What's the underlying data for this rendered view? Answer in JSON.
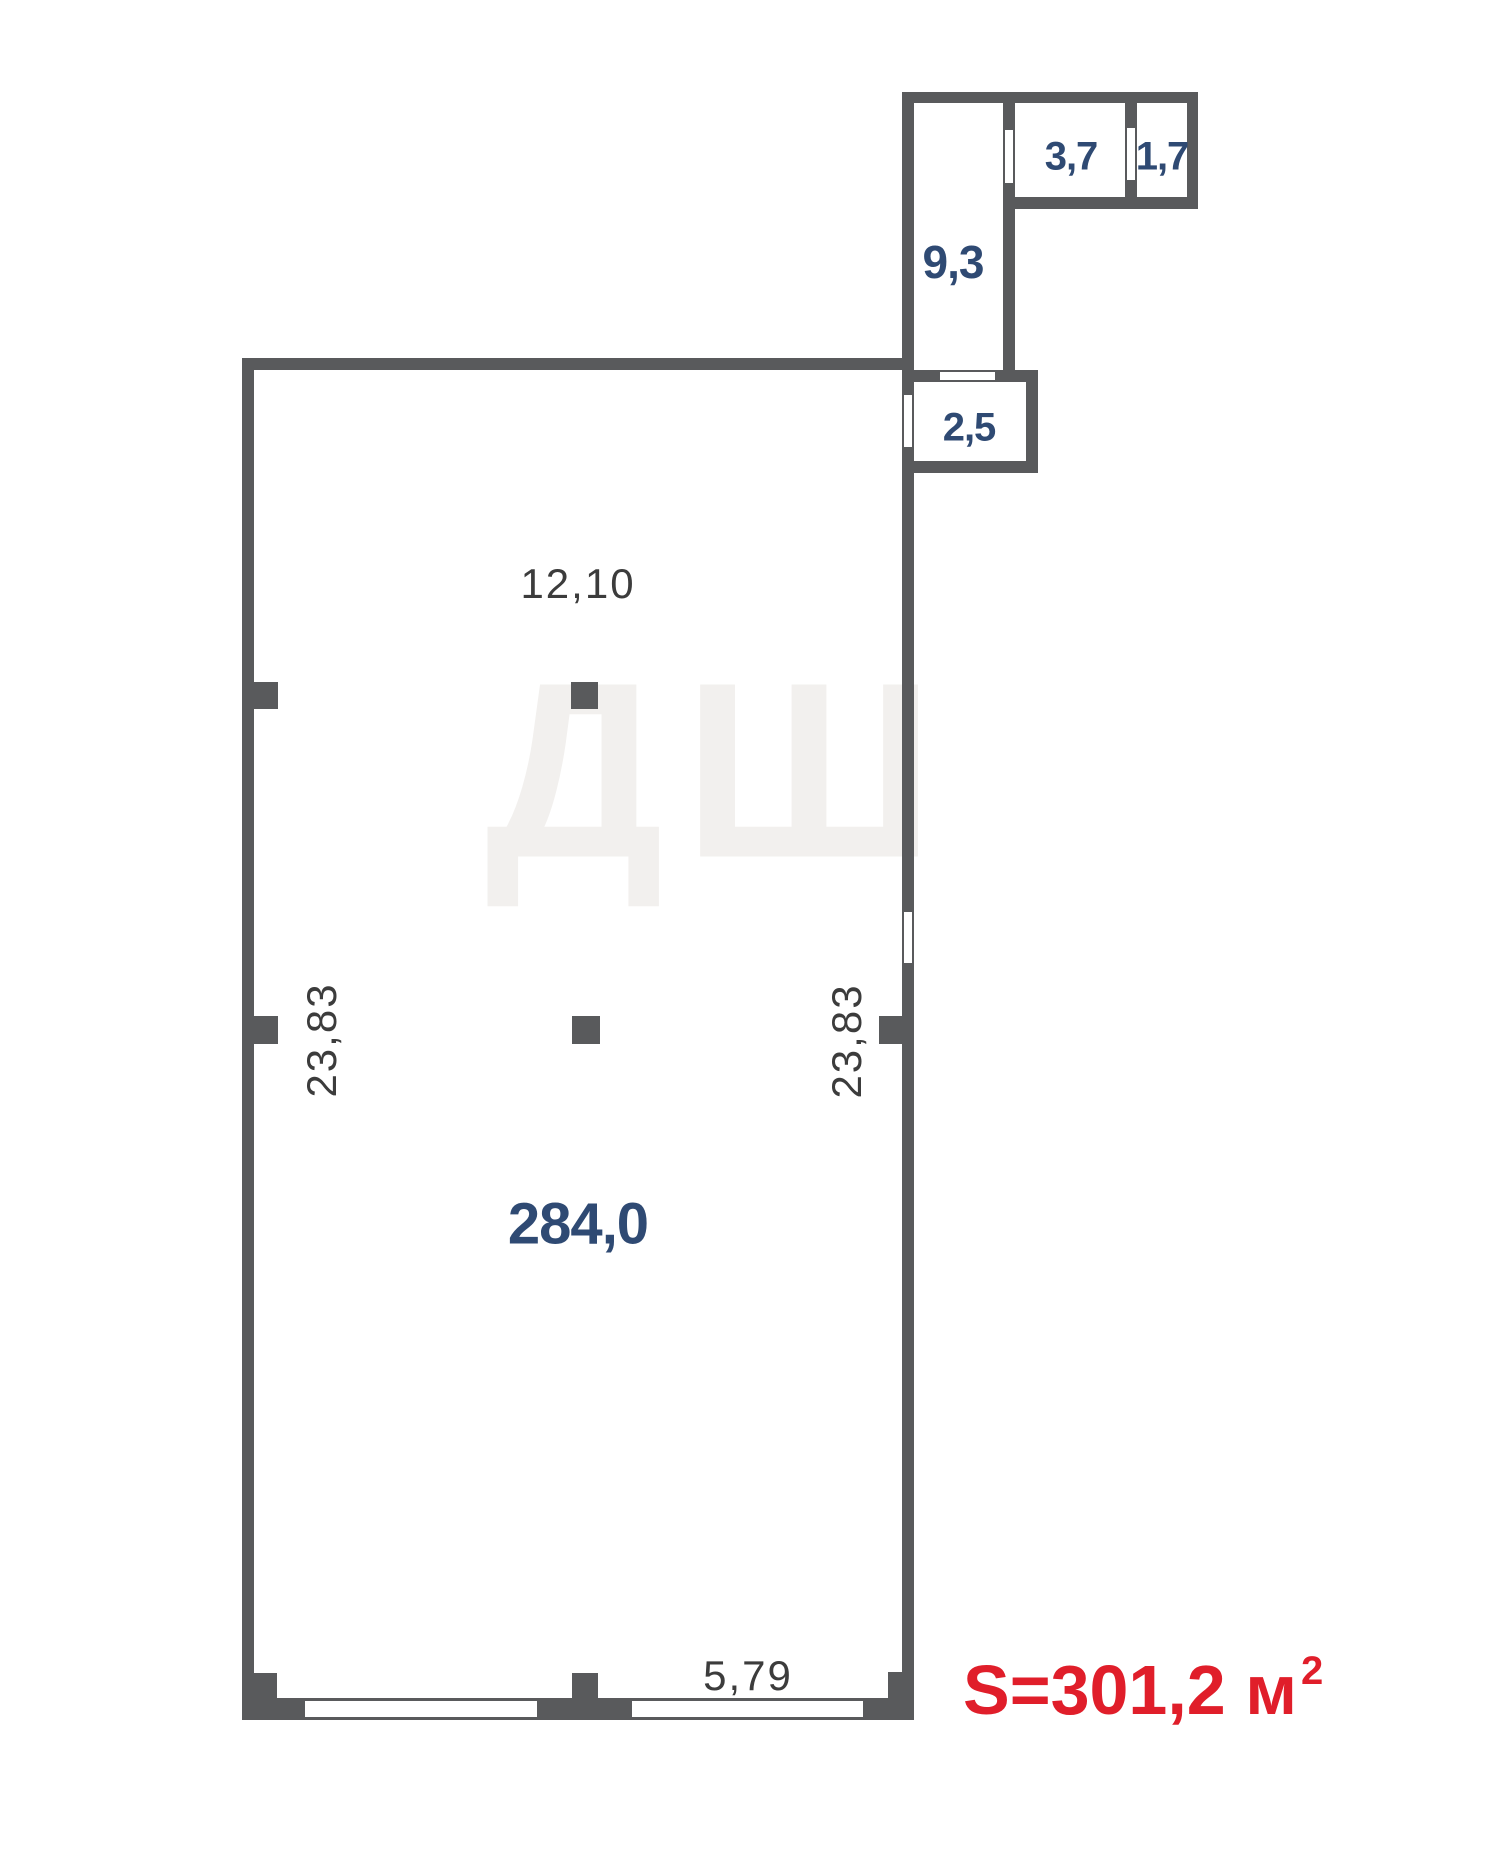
{
  "plan": {
    "type": "floor-plan",
    "colors": {
      "wall": "#595A5C",
      "room_label": "#2F4A73",
      "dimension_label": "#3C3C3C",
      "total_area": "#E01E2A",
      "background": "#FFFFFF"
    },
    "rooms": {
      "main": {
        "label": "284,0"
      },
      "corridor": {
        "label": "9,3"
      },
      "r37": {
        "label": "3,7"
      },
      "r17": {
        "label": "1,7"
      },
      "r25": {
        "label": "2,5"
      }
    },
    "dimensions": {
      "top": "12,10",
      "left": "23,83",
      "right": "23,83",
      "bottom": "5,79"
    },
    "total": {
      "text": "S=301,2 м",
      "sup": "2"
    },
    "watermark": "ДШ"
  }
}
